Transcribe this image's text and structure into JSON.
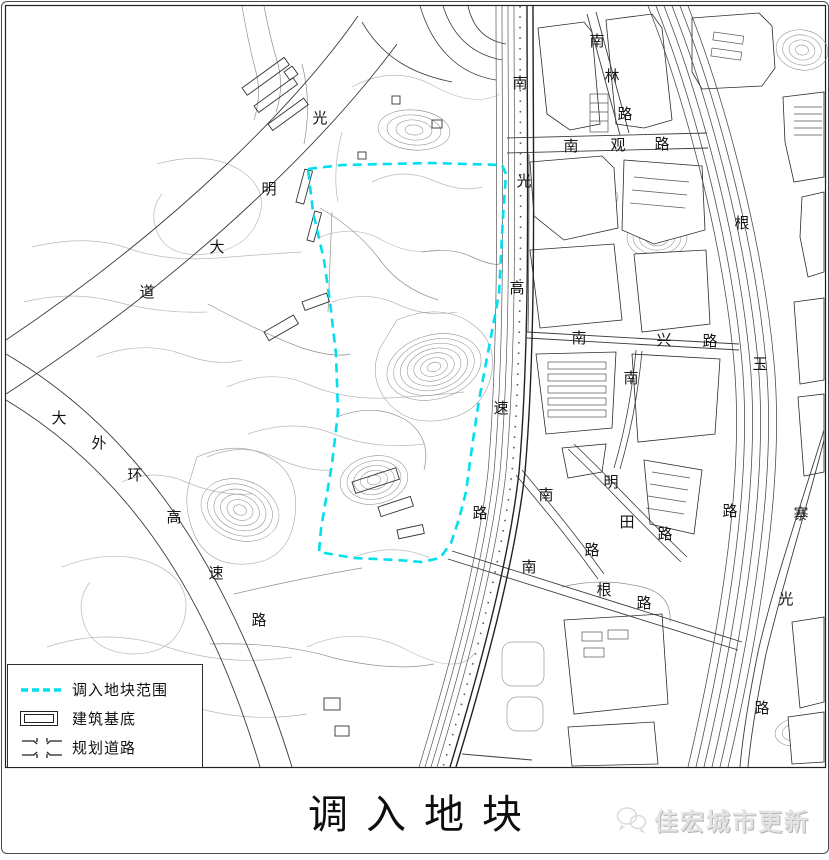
{
  "title": "调入地块",
  "watermark": {
    "text": "佳宏城市更新",
    "icon": "wechat-icon"
  },
  "legend": {
    "items": [
      {
        "id": "boundary",
        "symbol": "cyan-dashed-line",
        "label": "调入地块范围"
      },
      {
        "id": "building",
        "symbol": "double-rectangle",
        "label": "建筑基底"
      },
      {
        "id": "road",
        "symbol": "crossroad-glyph",
        "label": "规划道路"
      }
    ]
  },
  "colors": {
    "boundary_cyan": "#00dfee",
    "road_line": "#3c3c3c",
    "contour_gray": "#b9b9b9",
    "watermark_gray": "#e3e3e3"
  },
  "map": {
    "road_labels": [
      {
        "road": "光明大道",
        "chars": [
          {
            "t": "光",
            "x": 318,
            "y": 117
          },
          {
            "t": "明",
            "x": 267,
            "y": 188
          },
          {
            "t": "大",
            "x": 215,
            "y": 246
          },
          {
            "t": "道",
            "x": 145,
            "y": 291
          }
        ]
      },
      {
        "road": "大外环高速路",
        "chars": [
          {
            "t": "大",
            "x": 57,
            "y": 417
          },
          {
            "t": "外",
            "x": 97,
            "y": 442
          },
          {
            "t": "环",
            "x": 133,
            "y": 474
          },
          {
            "t": "高",
            "x": 172,
            "y": 516
          },
          {
            "t": "速",
            "x": 214,
            "y": 572
          },
          {
            "t": "路",
            "x": 257,
            "y": 619
          }
        ]
      },
      {
        "road": "南光高速路",
        "chars": [
          {
            "t": "南",
            "x": 518,
            "y": 82
          },
          {
            "t": "光",
            "x": 522,
            "y": 180
          },
          {
            "t": "高",
            "x": 515,
            "y": 287
          },
          {
            "t": "速",
            "x": 499,
            "y": 407
          },
          {
            "t": "路",
            "x": 478,
            "y": 512
          }
        ]
      },
      {
        "road": "南林路",
        "chars": [
          {
            "t": "南",
            "x": 595,
            "y": 40
          },
          {
            "t": "林",
            "x": 610,
            "y": 75
          },
          {
            "t": "路",
            "x": 623,
            "y": 113
          }
        ]
      },
      {
        "road": "南观路",
        "chars": [
          {
            "t": "南",
            "x": 569,
            "y": 145
          },
          {
            "t": "观",
            "x": 616,
            "y": 144
          },
          {
            "t": "路",
            "x": 660,
            "y": 143
          }
        ]
      },
      {
        "road": "根玉路",
        "chars": [
          {
            "t": "根",
            "x": 740,
            "y": 222
          },
          {
            "t": "玉",
            "x": 758,
            "y": 363
          },
          {
            "t": "路",
            "x": 728,
            "y": 510
          }
        ]
      },
      {
        "road": "南兴路",
        "chars": [
          {
            "t": "南",
            "x": 577,
            "y": 337
          },
          {
            "t": "兴",
            "x": 662,
            "y": 339
          },
          {
            "t": "路",
            "x": 708,
            "y": 340
          }
        ]
      },
      {
        "road": "南",
        "chars": [
          {
            "t": "南",
            "x": 629,
            "y": 377
          }
        ]
      },
      {
        "road": "明田路",
        "chars": [
          {
            "t": "明",
            "x": 609,
            "y": 481
          },
          {
            "t": "田",
            "x": 625,
            "y": 521
          },
          {
            "t": "路",
            "x": 663,
            "y": 533
          }
        ]
      },
      {
        "road": "南路",
        "chars": [
          {
            "t": "南",
            "x": 544,
            "y": 494
          },
          {
            "t": "路",
            "x": 590,
            "y": 549
          }
        ]
      },
      {
        "road": "南根路",
        "chars": [
          {
            "t": "南",
            "x": 527,
            "y": 566
          },
          {
            "t": "根",
            "x": 602,
            "y": 589
          },
          {
            "t": "路",
            "x": 642,
            "y": 602
          }
        ]
      },
      {
        "road": "寨光路",
        "chars": [
          {
            "t": "寨",
            "x": 799,
            "y": 513
          },
          {
            "t": "光",
            "x": 784,
            "y": 598
          },
          {
            "t": "路",
            "x": 760,
            "y": 707
          }
        ]
      }
    ]
  }
}
